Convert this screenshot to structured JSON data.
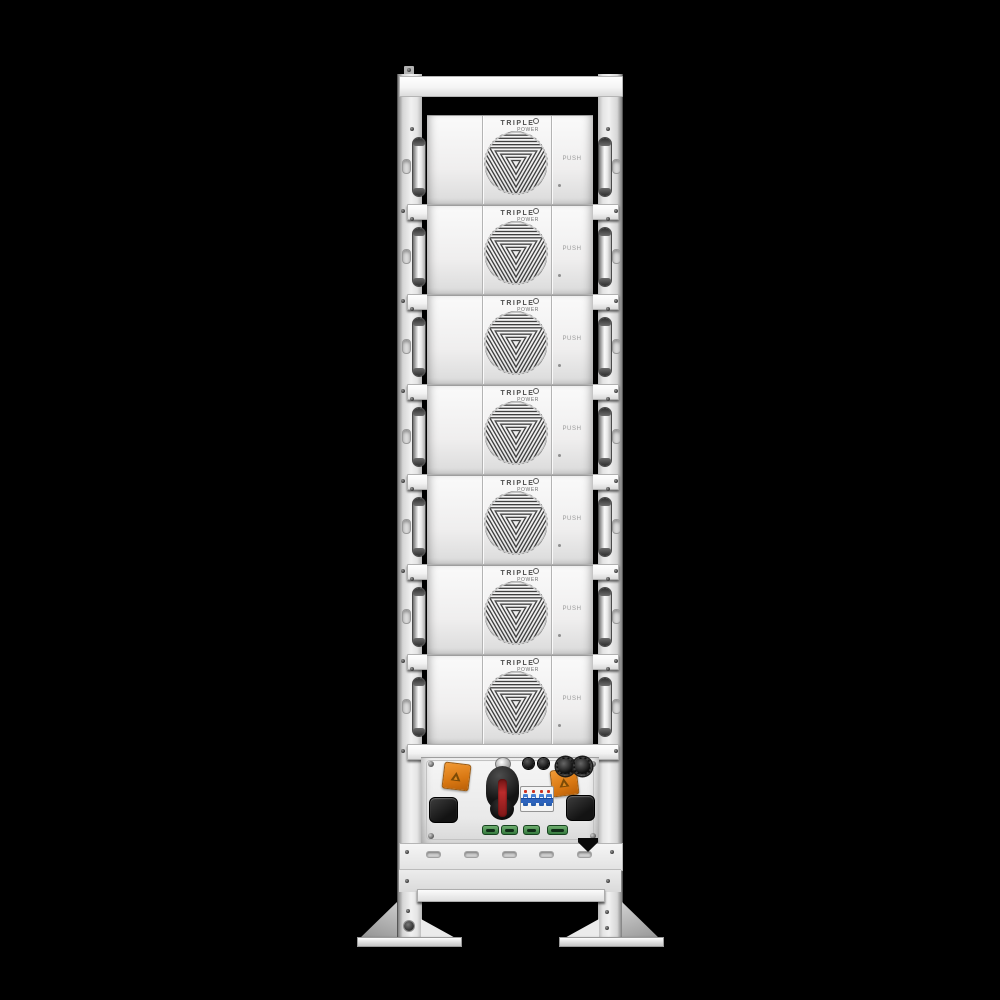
{
  "scene": {
    "background_color": "#000000",
    "subject": "white stacked battery tower rack, front view"
  },
  "rack": {
    "module_count": 7,
    "modules": [
      {
        "id": 1,
        "logo_line1": "TRIPLE",
        "logo_line2": "POWER",
        "button_label": "PUSH"
      },
      {
        "id": 2,
        "logo_line1": "TRIPLE",
        "logo_line2": "POWER",
        "button_label": "PUSH"
      },
      {
        "id": 3,
        "logo_line1": "TRIPLE",
        "logo_line2": "POWER",
        "button_label": "PUSH"
      },
      {
        "id": 4,
        "logo_line1": "TRIPLE",
        "logo_line2": "POWER",
        "button_label": "PUSH"
      },
      {
        "id": 5,
        "logo_line1": "TRIPLE",
        "logo_line2": "POWER",
        "button_label": "PUSH"
      },
      {
        "id": 6,
        "logo_line1": "TRIPLE",
        "logo_line2": "POWER",
        "button_label": "PUSH"
      },
      {
        "id": 7,
        "logo_line1": "TRIPLE",
        "logo_line2": "POWER",
        "button_label": "PUSH"
      }
    ],
    "control_unit": {
      "components": [
        "corner-screw x4",
        "orange-safety-connector x2",
        "rotary-disconnect-switch",
        "round-knob-connector x2",
        "round-power-connector x2",
        "circuit-breaker-4-pole",
        "black-port-cover x2",
        "green-terminal-connector x4"
      ]
    },
    "colors": {
      "panel_white": "#f2f2f2",
      "frame_shadow": "#9a9a9a",
      "fan_grille": "#3d3d3d",
      "orange_connector": "#d87712",
      "switch_body": "#1a1a1a",
      "switch_stripe": "#a82424",
      "breaker_blue": "#2d63bd",
      "breaker_indicator_red": "#cc3322",
      "terminal_green": "#357a3e",
      "background": "#000000"
    }
  }
}
